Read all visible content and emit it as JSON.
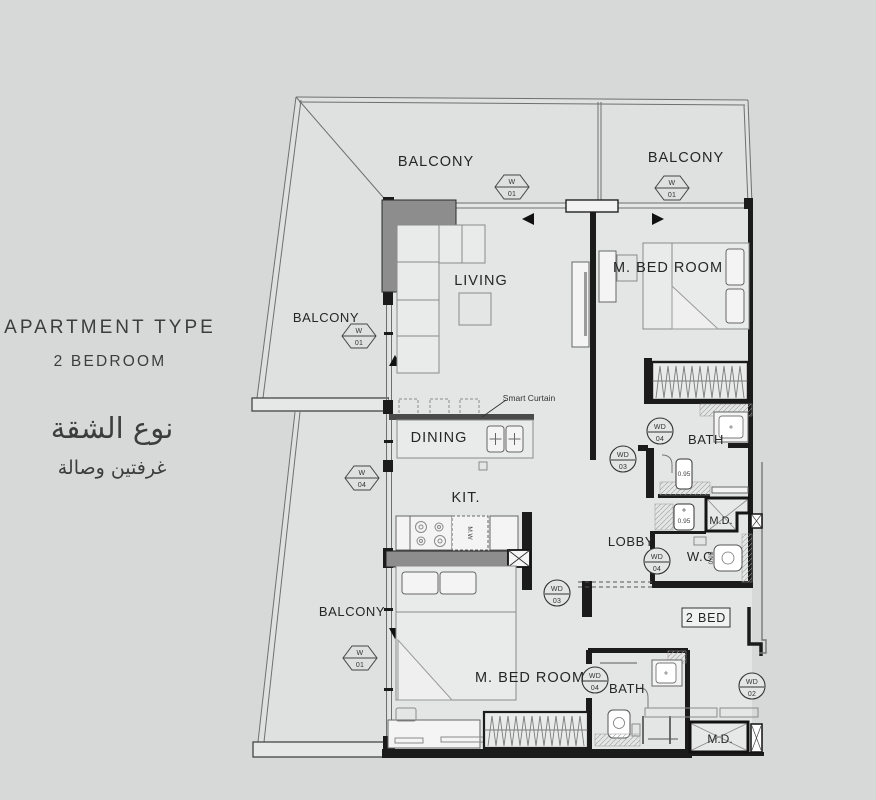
{
  "colors": {
    "page_background": "#d7d8d8",
    "balcony_floor": "#dfe0e0",
    "interior_floor": "#e4e5e5",
    "wall": "#1b1b1b",
    "column_fill": "#8d8d8d",
    "text": "#262626"
  },
  "info_panel": {
    "title": "APARTMENT TYPE",
    "subtitle": "2 BEDROOM",
    "title_arabic": "نوع الشقة",
    "subtitle_arabic": "غرفتين وصالة"
  },
  "plan": {
    "room_labels": [
      {
        "room": "balcony-top-left",
        "text": "BALCONY"
      },
      {
        "room": "balcony-top-right",
        "text": "BALCONY"
      },
      {
        "room": "balcony-left",
        "text": "BALCONY"
      },
      {
        "room": "balcony-bottom",
        "text": "BALCONY"
      },
      {
        "room": "living",
        "text": "LIVING"
      },
      {
        "room": "master-bedroom-top",
        "text": "M. BED ROOM"
      },
      {
        "room": "dining",
        "text": "DINING"
      },
      {
        "room": "kitchen",
        "text": "KIT."
      },
      {
        "room": "bath-top",
        "text": "BATH"
      },
      {
        "room": "lobby",
        "text": "LOBBY"
      },
      {
        "room": "wc",
        "text": "W.C"
      },
      {
        "room": "maid-room-middle",
        "text": "M.D."
      },
      {
        "room": "master-bedroom-bottom",
        "text": "M. BED ROOM"
      },
      {
        "room": "bath-bottom",
        "text": "BATH"
      },
      {
        "room": "maid-room-bottom",
        "text": "M.D."
      }
    ],
    "unit_label": {
      "text": "2 BED"
    },
    "curtain_note": {
      "text": "Smart Curtain"
    },
    "window_tags": [
      {
        "label": "W",
        "number": "01"
      },
      {
        "label": "W",
        "number": "01"
      },
      {
        "label": "W",
        "number": "01"
      },
      {
        "label": "W",
        "number": "04"
      },
      {
        "label": "W",
        "number": "01"
      }
    ],
    "door_tags": [
      {
        "label": "WD",
        "number": "04"
      },
      {
        "label": "WD",
        "number": "03"
      },
      {
        "label": "WD",
        "number": "04"
      },
      {
        "label": "WD",
        "number": "03"
      },
      {
        "label": "WD",
        "number": "04"
      },
      {
        "label": "WD",
        "number": "02"
      }
    ],
    "door_widths": [
      "0.95",
      "0.95",
      "0.95"
    ],
    "appliances": {
      "microwave": "M.W"
    }
  }
}
